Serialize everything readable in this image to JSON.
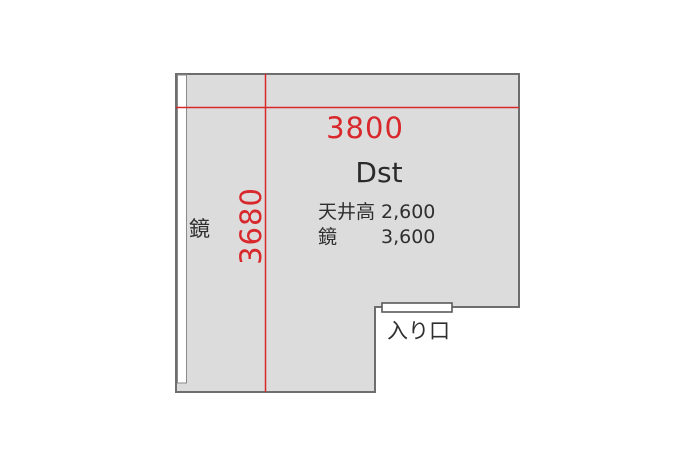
{
  "plan": {
    "room_label": "Dst",
    "width_dimension": "3800",
    "depth_dimension": "3680",
    "specs": {
      "ceiling": {
        "label": "天井高",
        "value": "2,600"
      },
      "mirror": {
        "label": "鏡",
        "value": "3,600"
      }
    },
    "wall_mirror_label": "鏡",
    "entrance_label": "入り口",
    "colors": {
      "room_fill": "#dcdcdc",
      "wall_stroke": "#6e6e6e",
      "dimension_red": "#d8282c",
      "text_dark": "#2f2f2f",
      "mirror_fill": "#ffffff",
      "door_fill": "#ffffff"
    }
  }
}
